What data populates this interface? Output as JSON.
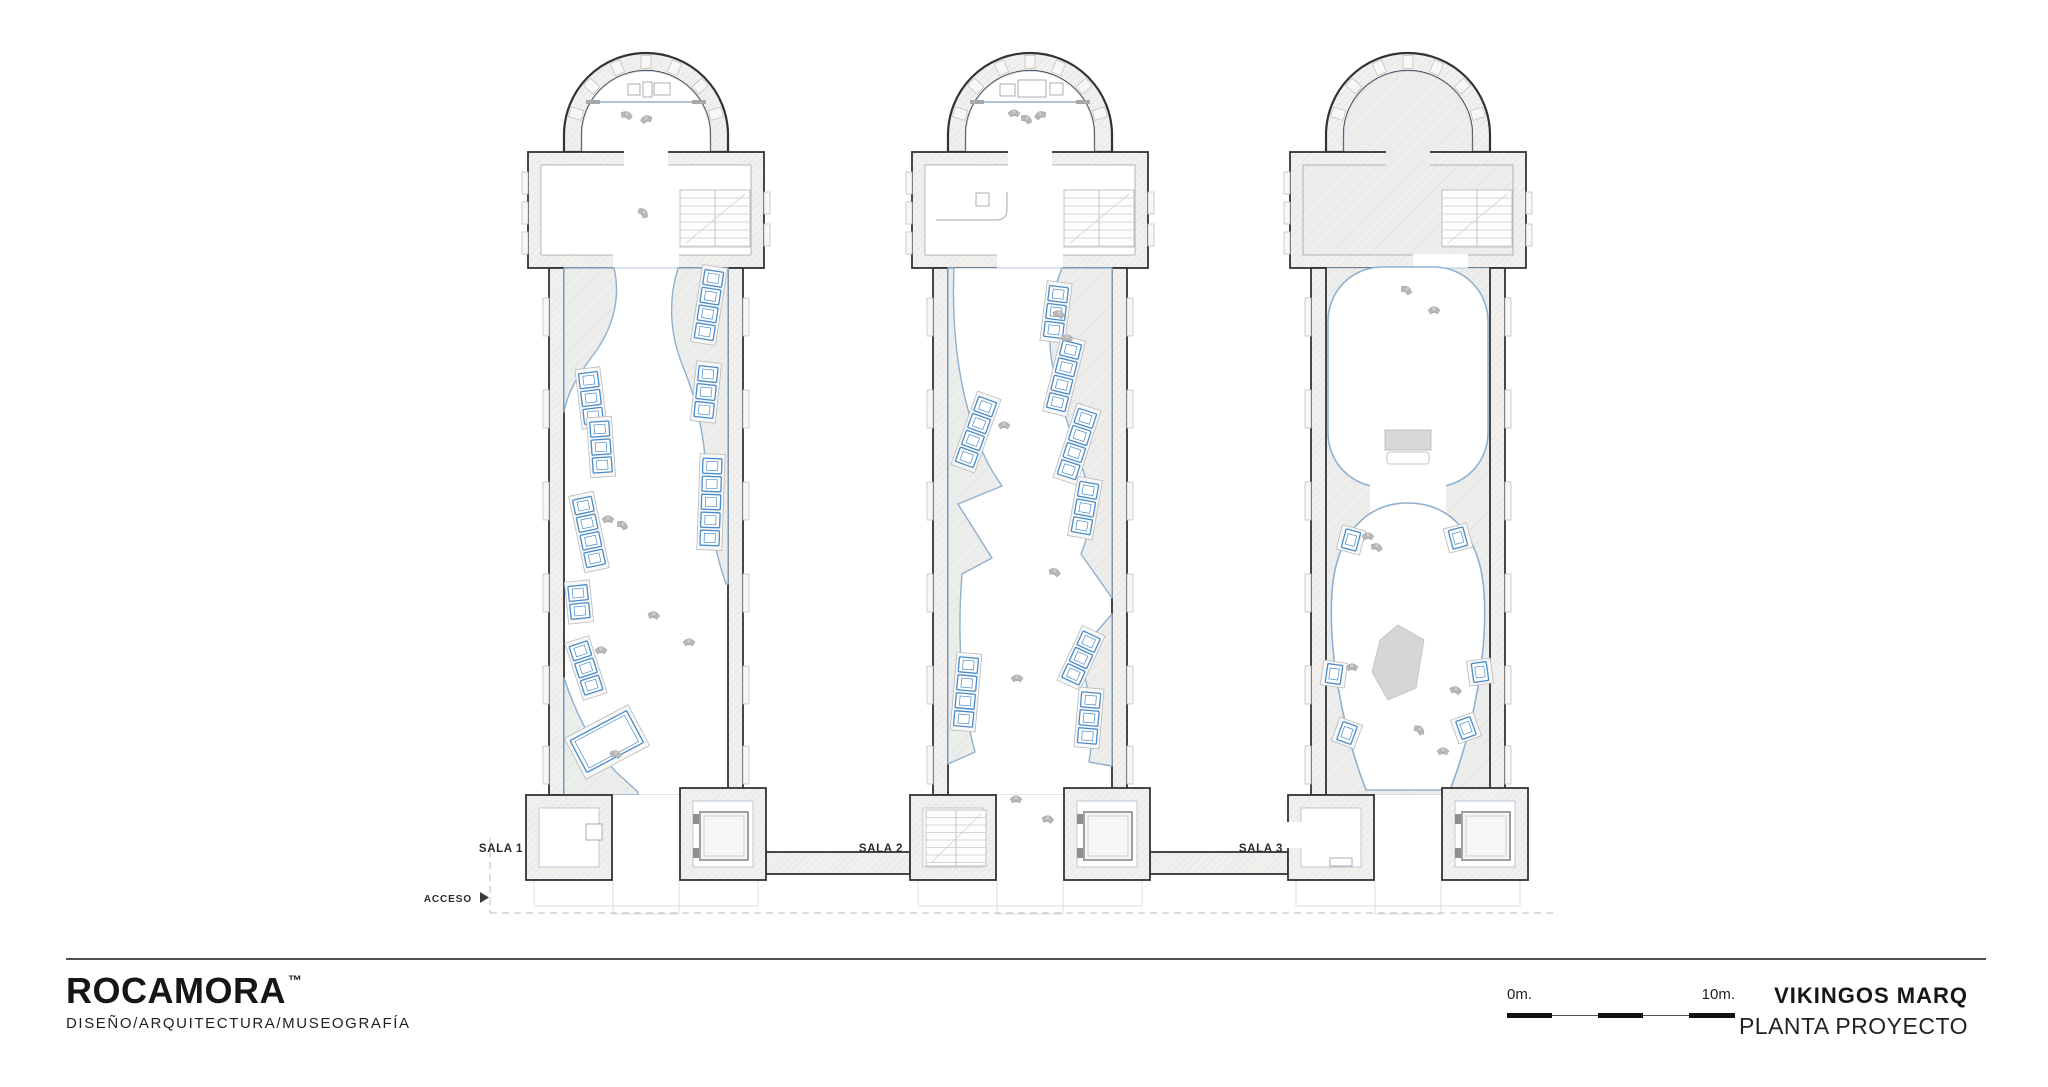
{
  "drawing": {
    "rooms": [
      {
        "label": "SALA 1"
      },
      {
        "label": "SALA 2"
      },
      {
        "label": "SALA 3"
      }
    ],
    "access_label": "ACCESO"
  },
  "scalebar": {
    "start_label": "0m.",
    "end_label": "10m."
  },
  "titleblock": {
    "project_title": "VIKINGOS MARQ",
    "sheet_title": "PLANTA PROYECTO"
  },
  "footer": {
    "brand": "ROCAMORA",
    "brand_tm": "™",
    "tagline": "DISEÑO/ARQUITECTURA/MUSEOGRAFÍA"
  },
  "colors": {
    "accent_blue": "#4a8bc8",
    "edge_blue": "#8fb0cf",
    "wall_line": "#333333",
    "poche_gray": "#ededec",
    "figure_gray": "#b9b9b9"
  }
}
